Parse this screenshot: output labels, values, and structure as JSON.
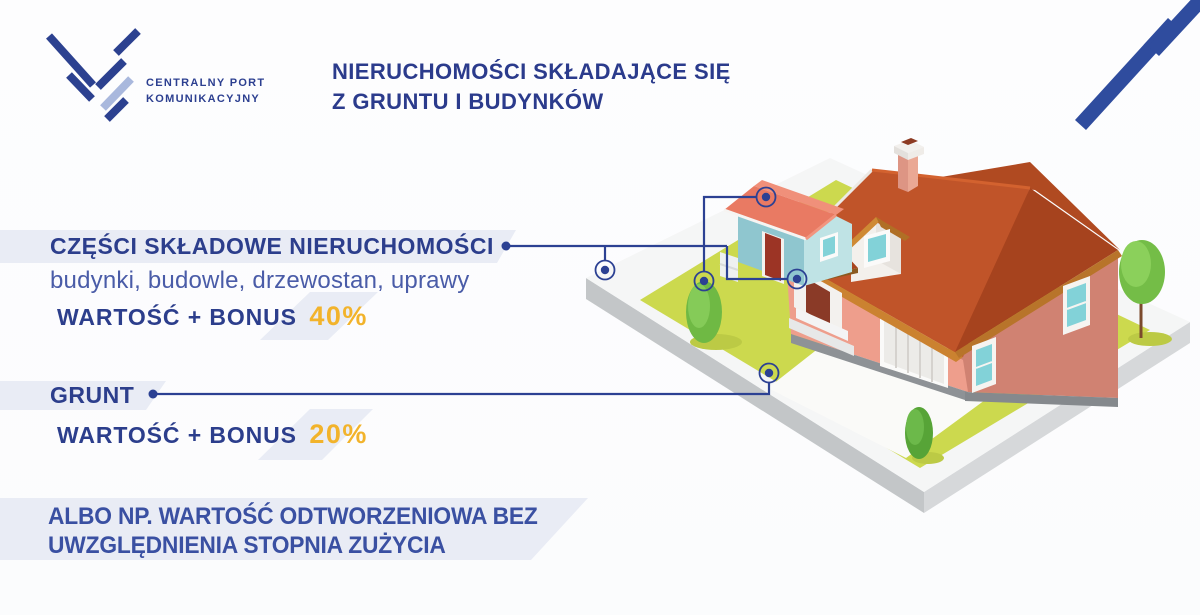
{
  "logo": {
    "line1": "CENTRALNY PORT",
    "line2": "KOMUNIKACYJNY"
  },
  "header": {
    "title_line1": "NIERUCHOMOŚCI SKŁADAJĄCE SIĘ",
    "title_line2": "Z GRUNTU I BUDYNKÓW"
  },
  "components_section": {
    "heading": "CZĘŚCI SKŁADOWE NIERUCHOMOŚCI",
    "subtitle": "budynki, budowle, drzewostan, uprawy",
    "value_label": "WARTOŚĆ + BONUS",
    "bonus_value": "40%"
  },
  "land_section": {
    "heading": "GRUNT",
    "value_label": "WARTOŚĆ + BONUS",
    "bonus_value": "20%"
  },
  "note_section": {
    "line1": "ALBO NP. WARTOŚĆ ODTWORZENIOWA BEZ",
    "line2": "UWZGLĘDNIENIA STOPNIA ZUŻYCIA"
  },
  "colors": {
    "primary_blue": "#2c3e8c",
    "subtitle_blue": "#4a5ca8",
    "note_blue": "#3a50a2",
    "accent_orange": "#f2b32b",
    "connector_blue": "#2c4193",
    "band_gray": "#e9ecf5",
    "logo_dark_blue": "#2c4190",
    "logo_light_blue": "#a9b8dd",
    "lawn_green": "#ccd94e",
    "roof_red": "#a6431e"
  }
}
